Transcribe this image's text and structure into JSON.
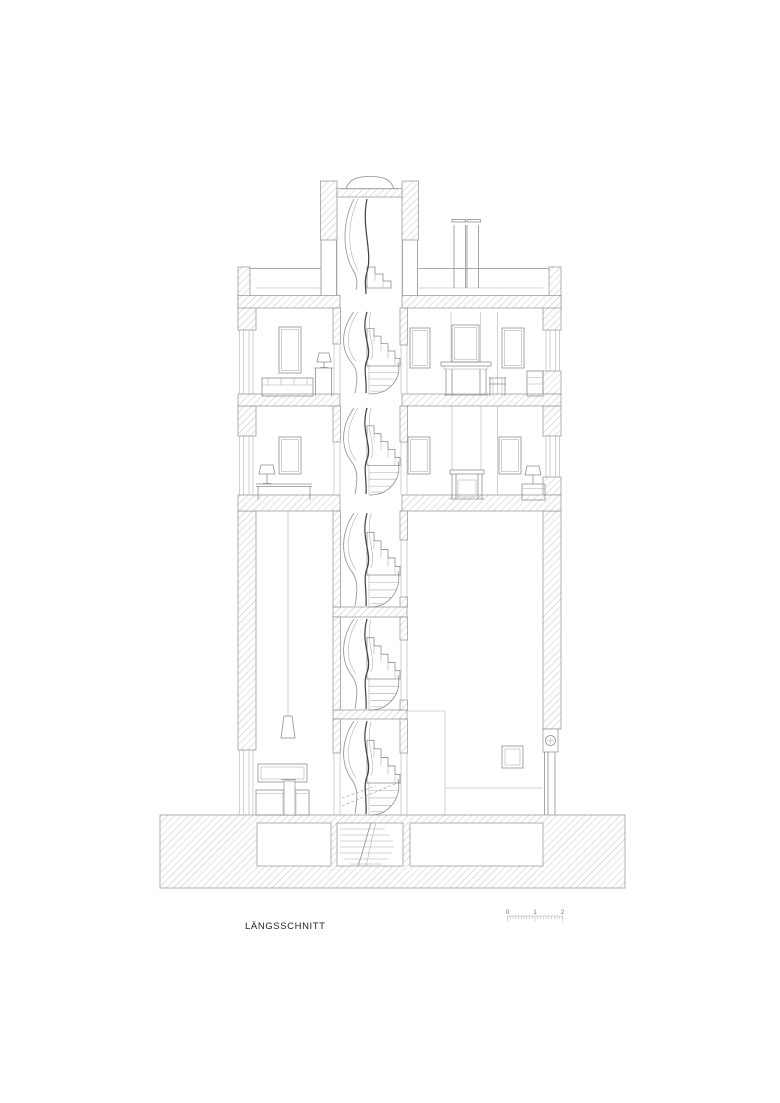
{
  "page": {
    "background": "#ffffff"
  },
  "drawing": {
    "title": "LÄNGSSCHNITT",
    "type": "architectural-longitudinal-section",
    "colors": {
      "line": "#8f8f8f",
      "dark_line": "#3f3f3f",
      "hatch": "#c6c6c6",
      "text": "#1f1f1f",
      "background": "#ffffff"
    },
    "levels": [
      "basement",
      "ground floor",
      "upper floor 1",
      "upper floor 2",
      "roof terrace with stair tower"
    ],
    "elements": [
      "spiral staircase",
      "domed skylight",
      "chimney",
      "fireplace with mirror",
      "pendant lamp",
      "kitchen counter",
      "sofa",
      "desk",
      "table lamps",
      "windows",
      "entry door",
      "cellar rooms"
    ]
  },
  "scale_bar": {
    "labels": [
      "0",
      "1",
      "2"
    ]
  }
}
